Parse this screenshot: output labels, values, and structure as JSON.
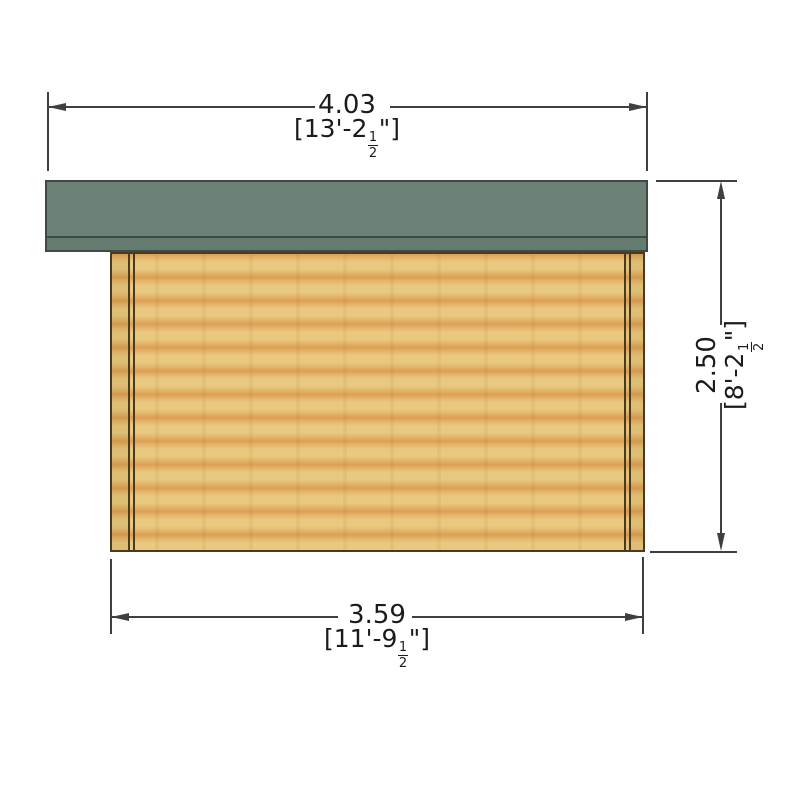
{
  "diagram": {
    "view": "log-cabin-side-elevation",
    "dimension_top": {
      "metric": "4.03",
      "imperial_full": "[13'-2 1/2\"]",
      "imperial_prefix": "[13'-2",
      "fraction_numerator": "1",
      "fraction_denominator": "2",
      "imperial_suffix": "\"]"
    },
    "dimension_right": {
      "metric": "2.50",
      "imperial_full": "[8'-2 1/2\"]",
      "imperial_prefix": "[8'-2",
      "fraction_numerator": "1",
      "fraction_denominator": "2",
      "imperial_suffix": "\"]"
    },
    "dimension_bottom": {
      "metric": "3.59",
      "imperial_full": "[11'-9 1/2\"]",
      "imperial_prefix": "[11'-9",
      "fraction_numerator": "1",
      "fraction_denominator": "2",
      "imperial_suffix": "\"]"
    },
    "colors": {
      "background": "#ffffff",
      "roof": "#6d8277",
      "roof_fascia": "#657b70",
      "roof_outline": "#3e4b44",
      "wood_light": "#e9c87f",
      "wood_mid": "#e3b76c",
      "wood_dark": "#dd9f53",
      "wall_outline": "#4a3a20",
      "dimension_line": "#3f3f3f",
      "text": "#1b1b1b"
    }
  }
}
